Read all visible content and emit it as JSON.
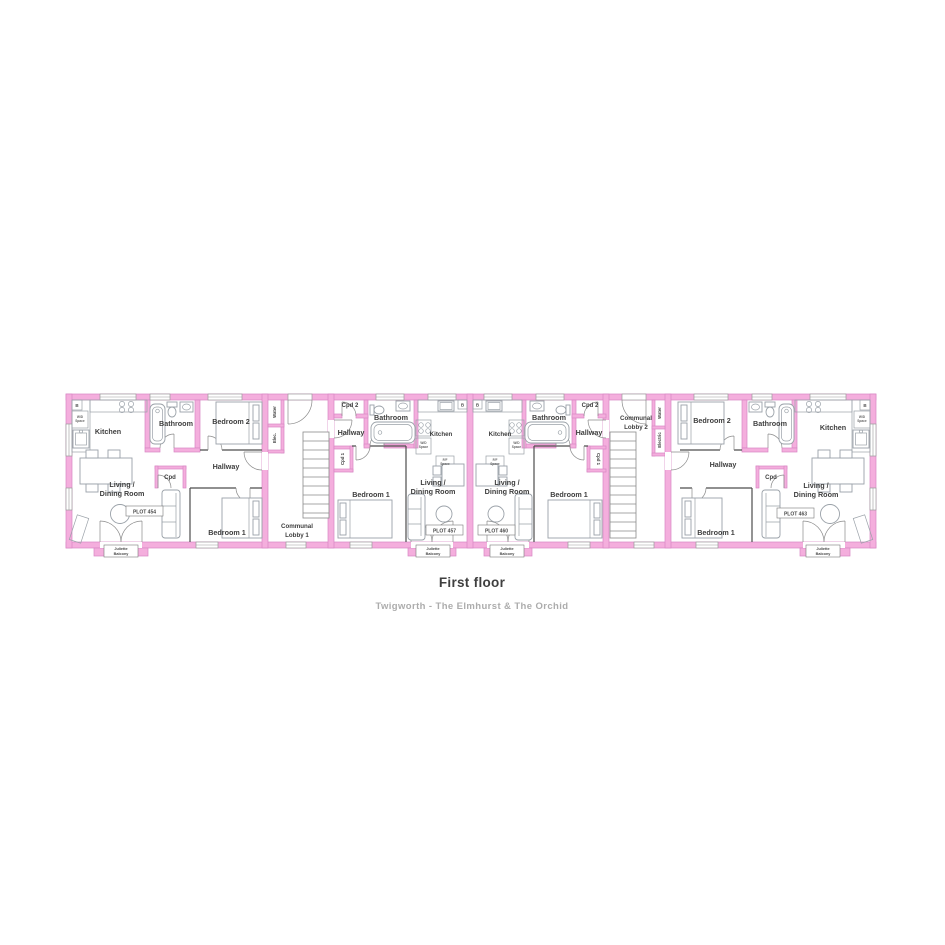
{
  "title": "First floor",
  "subtitle": "Twigworth - The Elmhurst & The Orchid",
  "colors": {
    "wall_fill": "#F4AEDD",
    "wall_border": "#D887C4",
    "interior_line": "#4D4D4D",
    "furniture": "#9AA1A8",
    "label_text": "#3E3E3E",
    "subtitle_text": "#ACACAC"
  },
  "rooms": {
    "kitchen": "Kitchen",
    "bathroom": "Bathroom",
    "bedroom1": "Bedroom 1",
    "bedroom2": "Bedroom 2",
    "hallway": "Hallway",
    "cpd": "Cpd",
    "cpd1": "Cpd 1",
    "cpd2": "Cpd 2",
    "living_line1": "Living /",
    "living_line2": "Dining Room"
  },
  "balcony": {
    "line1": "Juliette",
    "line2": "Balcony"
  },
  "utilities": {
    "water": "Water",
    "elec": "Elec.",
    "electric": "Electric",
    "boiler": "B",
    "wd_line1": "W/D",
    "ff_line1": "F/F",
    "space_line2": "Space"
  },
  "lobbies": {
    "lobby1_line1": "Communal",
    "lobby1_line2": "Lobby 1",
    "lobby2_line1": "Communal",
    "lobby2_line2": "Lobby 2"
  },
  "plots": {
    "p454": "PLOT 454",
    "p457": "PLOT 457",
    "p460": "PLOT 460",
    "p463": "PLOT 463"
  }
}
